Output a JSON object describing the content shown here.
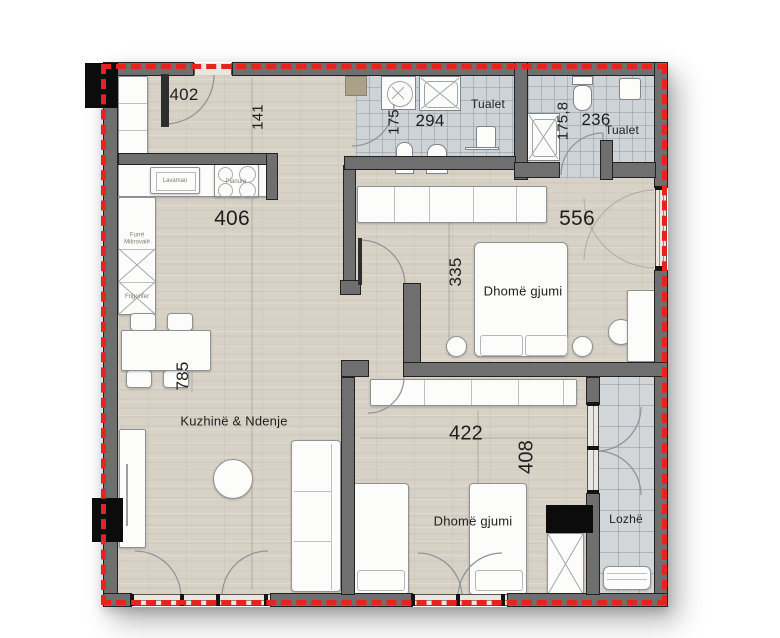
{
  "plan_title": "apartment floor plan",
  "rooms": {
    "hall": {
      "width_dim": "402",
      "height_dim": "141"
    },
    "bath_left": {
      "label": "Tualet",
      "height_dim": "175",
      "width_dim": "294"
    },
    "bath_right": {
      "label": "Tualet",
      "height_dim": "175,8",
      "width_dim": "236"
    },
    "kitchen_living": {
      "label": "Kuzhinë & Ndenje",
      "width_dim": "406",
      "height_dim": "785"
    },
    "bedroom_main": {
      "label": "Dhomë gjumi",
      "width_dim": "556",
      "height_dim": "335"
    },
    "bedroom_second": {
      "label": "Dhomë gjumi",
      "width_dim": "422",
      "height_dim": "408"
    },
    "loggia": {
      "label": "Lozhë"
    }
  },
  "appliances": {
    "sink": "Lavaman",
    "cooktop": "Pianure",
    "microwave": "Furrë Mikrovalë",
    "fridge": "Frigorifer"
  },
  "colors": {
    "boundary_dash": "#e8231f",
    "wall_fill": "#6f6f6f",
    "wall_edge": "#222222",
    "wood_floor": "#d8d2c6",
    "tile_floor": "#cdd3d7"
  }
}
